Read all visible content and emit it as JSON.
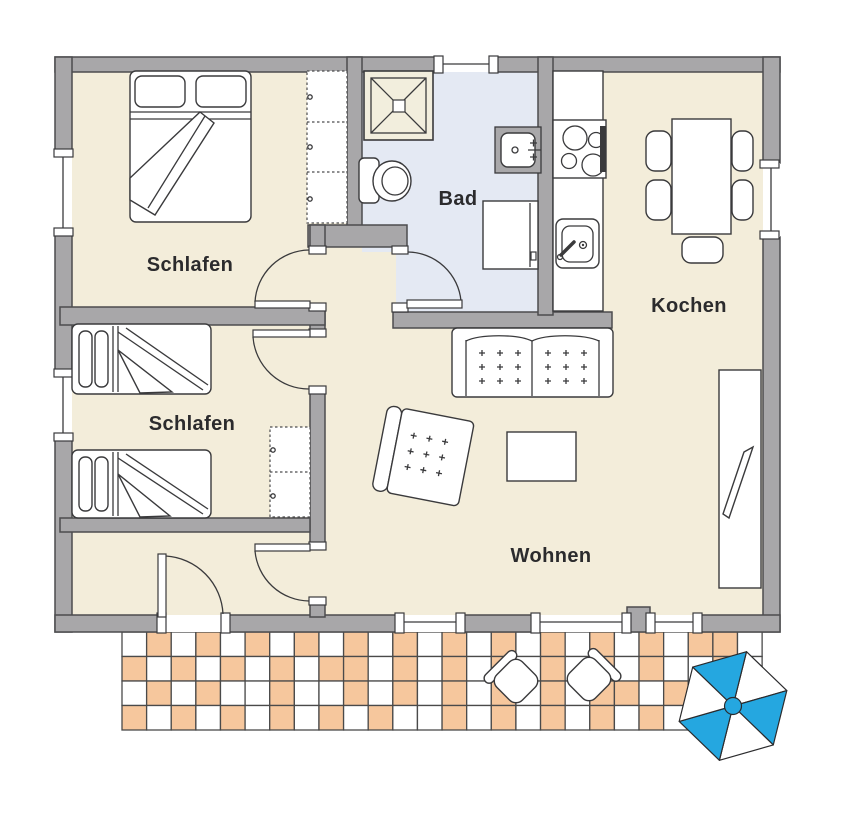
{
  "labels": {
    "bedroom1": "Schlafen",
    "bedroom2": "Schlafen",
    "bath": "Bad",
    "kitchen": "Kochen",
    "living": "Wohnen"
  },
  "colors": {
    "floor": "#f3edda",
    "bath_floor": "#e4e9f3",
    "shower_tray": "#f2eedd",
    "wall_fill": "#a8a7a9",
    "wall_stroke": "#4c4c4e",
    "line": "#3a3a3c",
    "text": "#2b2b2d",
    "terrace_tile_orange": "#f6c79d",
    "terrace_tile_white": "#ffffff",
    "tile_grid": "#4a4a4a",
    "parasol_blue": "#25a7e0",
    "parasol_white": "#ffffff"
  },
  "terrace": {
    "rows": 4,
    "cols": 26,
    "pattern": [
      "WOWOWOWOWOWOWOWOWOWOWOWOOW",
      "OWOWOWOWOOWOWOWOWOWOWOWWOW",
      "WOWOWWOWWOWOWOWOWOWOOWOWWO",
      "OWOWOWOWOWOWWOWOWOWOWOWOWO"
    ]
  }
}
